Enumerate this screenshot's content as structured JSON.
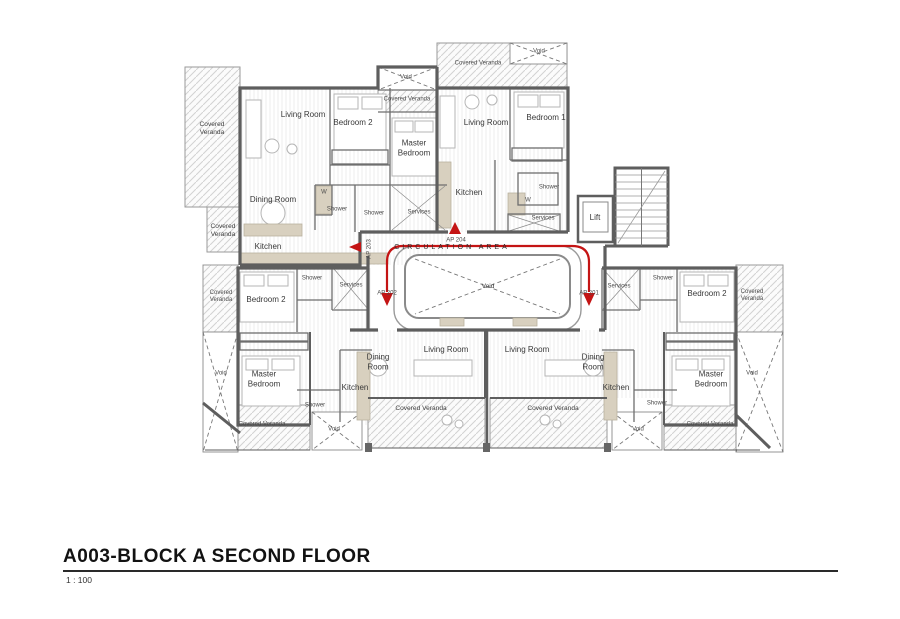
{
  "title_block": {
    "drawing_title": "A003-BLOCK A SECOND FLOOR",
    "scale": "1 : 100"
  },
  "plan": {
    "colors": {
      "route_red": "#c41414",
      "wall_gray": "#5e5e5e",
      "counter_beige": "#d8d0bf"
    },
    "labels": [
      {
        "name": "room-label-covered-veranda-tl-big",
        "text": "Covered\nVeranda",
        "x": 212,
        "y": 129,
        "size": "s"
      },
      {
        "name": "room-label-covered-veranda-tl-small",
        "text": "Covered\nVeranda",
        "x": 223,
        "y": 231,
        "size": "s"
      },
      {
        "name": "room-label-living-room-tl",
        "text": "Living Room",
        "x": 303,
        "y": 115,
        "size": "m"
      },
      {
        "name": "room-label-bedroom-2-tl",
        "text": "Bedroom 2",
        "x": 353,
        "y": 123,
        "size": "m"
      },
      {
        "name": "room-label-master-bedroom-tl",
        "text": "Master\nBedroom",
        "x": 414,
        "y": 148,
        "size": "m"
      },
      {
        "name": "room-label-dining-room-tl",
        "text": "Dining Room",
        "x": 273,
        "y": 200,
        "size": "m"
      },
      {
        "name": "room-label-kitchen-tl",
        "text": "Kitchen",
        "x": 268,
        "y": 247,
        "size": "m"
      },
      {
        "name": "room-label-w-closet-tl",
        "text": "W",
        "x": 324,
        "y": 193,
        "size": "xs"
      },
      {
        "name": "room-label-shower-tl-1",
        "text": "Shower",
        "x": 337,
        "y": 210,
        "size": "xs"
      },
      {
        "name": "room-label-shower-tl-2",
        "text": "Shower",
        "x": 374,
        "y": 214,
        "size": "xs"
      },
      {
        "name": "room-label-services-tl",
        "text": "Services",
        "x": 419,
        "y": 213,
        "size": "xs"
      },
      {
        "name": "room-label-void-top-center",
        "text": "Void",
        "x": 406,
        "y": 78,
        "size": "xs"
      },
      {
        "name": "room-label-covered-veranda-top-center",
        "text": "Covered Veranda",
        "x": 407,
        "y": 100,
        "size": "xs"
      },
      {
        "name": "room-label-covered-veranda-tr",
        "text": "Covered Veranda",
        "x": 478,
        "y": 64,
        "size": "xs"
      },
      {
        "name": "room-label-void-tr",
        "text": "Void",
        "x": 539,
        "y": 52,
        "size": "xs"
      },
      {
        "name": "room-label-living-room-tr",
        "text": "Living Room",
        "x": 486,
        "y": 123,
        "size": "m"
      },
      {
        "name": "room-label-bedroom-1-tr",
        "text": "Bedroom 1",
        "x": 546,
        "y": 118,
        "size": "m"
      },
      {
        "name": "room-label-kitchen-tr",
        "text": "Kitchen",
        "x": 469,
        "y": 193,
        "size": "m"
      },
      {
        "name": "room-label-shower-tr",
        "text": "Shower",
        "x": 549,
        "y": 188,
        "size": "xs"
      },
      {
        "name": "room-label-w-closet-tr",
        "text": "W",
        "x": 528,
        "y": 201,
        "size": "xs"
      },
      {
        "name": "room-label-services-tr",
        "text": "Services",
        "x": 543,
        "y": 219,
        "size": "xs"
      },
      {
        "name": "room-label-lift",
        "text": "Lift",
        "x": 595,
        "y": 218,
        "size": "m"
      },
      {
        "name": "circulation-area-label",
        "text": "CIRCULATION AREA",
        "x": 452,
        "y": 248,
        "size": "circ"
      },
      {
        "name": "apartment-tag-ap-204",
        "text": "AP 204",
        "x": 456,
        "y": 241,
        "size": "xs"
      },
      {
        "name": "apartment-tag-ap-203",
        "text": "AP 203",
        "x": 370,
        "y": 249,
        "size": "xs",
        "rot": 1
      },
      {
        "name": "apartment-tag-ap-202",
        "text": "AP 202",
        "x": 387,
        "y": 294,
        "size": "xs"
      },
      {
        "name": "apartment-tag-ap-201",
        "text": "AP 201",
        "x": 589,
        "y": 294,
        "size": "xs"
      },
      {
        "name": "room-label-void-central",
        "text": "Void",
        "x": 488,
        "y": 287,
        "size": "s"
      },
      {
        "name": "room-label-covered-veranda-bl-small",
        "text": "Covered\nVeranda",
        "x": 221,
        "y": 297,
        "size": "xs"
      },
      {
        "name": "room-label-bedroom-2-bl",
        "text": "Bedroom 2",
        "x": 266,
        "y": 300,
        "size": "m"
      },
      {
        "name": "room-label-shower-bl-1",
        "text": "Shower",
        "x": 312,
        "y": 279,
        "size": "xs"
      },
      {
        "name": "room-label-services-bl",
        "text": "Services",
        "x": 351,
        "y": 286,
        "size": "xs"
      },
      {
        "name": "room-label-void-bl-band",
        "text": "Void",
        "x": 221,
        "y": 374,
        "size": "xs"
      },
      {
        "name": "room-label-master-bedroom-bl",
        "text": "Master\nBedroom",
        "x": 264,
        "y": 379,
        "size": "m"
      },
      {
        "name": "room-label-kitchen-bl",
        "text": "Kitchen",
        "x": 355,
        "y": 388,
        "size": "m"
      },
      {
        "name": "room-label-dining-room-bl",
        "text": "Dining\nRoom",
        "x": 378,
        "y": 362,
        "size": "m"
      },
      {
        "name": "room-label-living-room-bl",
        "text": "Living Room",
        "x": 446,
        "y": 350,
        "size": "m"
      },
      {
        "name": "room-label-shower-bl-2",
        "text": "Shower",
        "x": 315,
        "y": 406,
        "size": "xs"
      },
      {
        "name": "room-label-covered-veranda-bl",
        "text": "Covered Veranda",
        "x": 262,
        "y": 425,
        "size": "xs"
      },
      {
        "name": "room-label-void-bl-box",
        "text": "Void",
        "x": 334,
        "y": 430,
        "size": "xs"
      },
      {
        "name": "room-label-covered-veranda-bc-left",
        "text": "Covered Veranda",
        "x": 421,
        "y": 409,
        "size": "s"
      },
      {
        "name": "room-label-covered-veranda-bc-right",
        "text": "Covered Veranda",
        "x": 553,
        "y": 409,
        "size": "s"
      },
      {
        "name": "room-label-living-room-br",
        "text": "Living Room",
        "x": 527,
        "y": 350,
        "size": "m"
      },
      {
        "name": "room-label-dining-room-br",
        "text": "Dining\nRoom",
        "x": 593,
        "y": 362,
        "size": "m"
      },
      {
        "name": "room-label-kitchen-br",
        "text": "Kitchen",
        "x": 616,
        "y": 388,
        "size": "m"
      },
      {
        "name": "room-label-shower-br-2",
        "text": "Shower",
        "x": 657,
        "y": 404,
        "size": "xs"
      },
      {
        "name": "room-label-master-bedroom-br",
        "text": "Master\nBedroom",
        "x": 711,
        "y": 379,
        "size": "m"
      },
      {
        "name": "room-label-void-br-band",
        "text": "Void",
        "x": 752,
        "y": 374,
        "size": "xs"
      },
      {
        "name": "room-label-void-br-box",
        "text": "Void",
        "x": 638,
        "y": 430,
        "size": "xs"
      },
      {
        "name": "room-label-covered-veranda-br",
        "text": "Covered Veranda",
        "x": 710,
        "y": 425,
        "size": "xs"
      },
      {
        "name": "room-label-services-br",
        "text": "Services",
        "x": 619,
        "y": 287,
        "size": "xs"
      },
      {
        "name": "room-label-shower-br-1",
        "text": "Shower",
        "x": 663,
        "y": 279,
        "size": "xs"
      },
      {
        "name": "room-label-bedroom-2-br",
        "text": "Bedroom 2",
        "x": 707,
        "y": 294,
        "size": "m"
      },
      {
        "name": "room-label-covered-veranda-br-small",
        "text": "Covered\nVeranda",
        "x": 752,
        "y": 296,
        "size": "xs"
      }
    ]
  }
}
